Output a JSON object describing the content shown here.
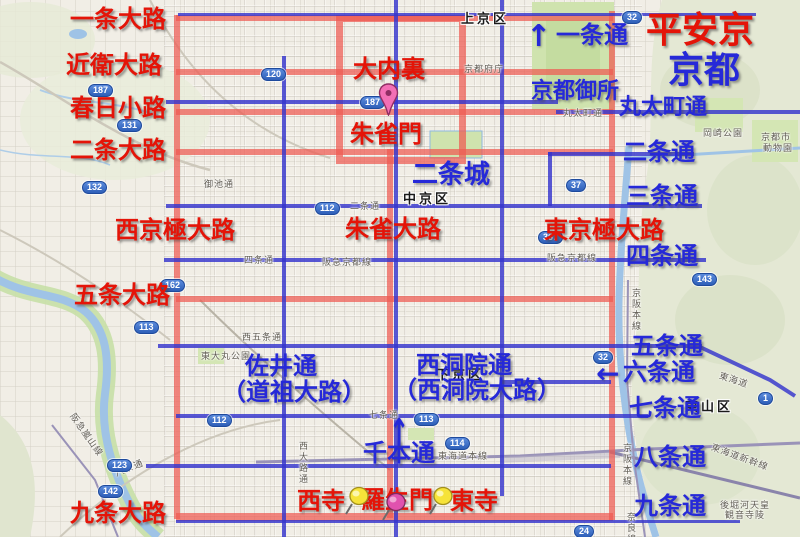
{
  "app": {
    "type": "map-screenshot",
    "description": "Heian-kyo ancient grid overlaid on modern Kyoto map"
  },
  "titles": {
    "ancient": {
      "text": "平安京"
    },
    "modern": {
      "text": "京都"
    }
  },
  "colors": {
    "ancient_label": "#e41408",
    "modern_label": "#2629d8",
    "ancient_line": "rgba(238,90,82,0.72)",
    "modern_line": "rgba(52,52,205,0.82)"
  },
  "districts": [
    {
      "text": "上京区",
      "x": 461,
      "y": 8
    },
    {
      "text": "中京区",
      "x": 403,
      "y": 188
    },
    {
      "text": "下京区",
      "x": 436,
      "y": 364
    },
    {
      "text": "東山区",
      "x": 685,
      "y": 396
    }
  ],
  "ancient_labels": [
    {
      "text": "一条大路",
      "x": 70,
      "y": 8
    },
    {
      "text": "近衛大路",
      "x": 66,
      "y": 54
    },
    {
      "text": "春日小路",
      "x": 70,
      "y": 97
    },
    {
      "text": "二条大路",
      "x": 70,
      "y": 139
    },
    {
      "text": "西京極大路",
      "x": 115,
      "y": 219
    },
    {
      "text": "五条大路",
      "x": 74,
      "y": 284
    },
    {
      "text": "九条大路",
      "x": 70,
      "y": 502
    },
    {
      "text": "大内裏",
      "x": 353,
      "y": 58
    },
    {
      "text": "朱雀門",
      "x": 350,
      "y": 123
    },
    {
      "text": "朱雀大路",
      "x": 345,
      "y": 218
    },
    {
      "text": "東京極大路",
      "x": 544,
      "y": 219
    },
    {
      "text": "西寺",
      "x": 297,
      "y": 490
    },
    {
      "text": "羅生門",
      "x": 361,
      "y": 489
    },
    {
      "text": "東寺",
      "x": 450,
      "y": 490
    }
  ],
  "modern_labels": [
    {
      "text": "一条通",
      "x": 556,
      "y": 24
    },
    {
      "text": "京都御所",
      "x": 531,
      "y": 79,
      "size": 22
    },
    {
      "text": "丸太町通",
      "x": 619,
      "y": 95,
      "size": 22
    },
    {
      "text": "二条通",
      "x": 623,
      "y": 141
    },
    {
      "text": "三条通",
      "x": 626,
      "y": 185
    },
    {
      "text": "四条通",
      "x": 626,
      "y": 245
    },
    {
      "text": "五条通",
      "x": 631,
      "y": 335
    },
    {
      "text": "六条通",
      "x": 623,
      "y": 361
    },
    {
      "text": "七条通",
      "x": 629,
      "y": 397
    },
    {
      "text": "八条通",
      "x": 634,
      "y": 446
    },
    {
      "text": "九条通",
      "x": 634,
      "y": 495
    },
    {
      "text": "二条城",
      "x": 412,
      "y": 161,
      "size": 26
    },
    {
      "text": "千本通",
      "x": 363,
      "y": 442
    },
    {
      "text": "佐井通",
      "x": 245,
      "y": 355
    },
    {
      "text": "（道祖大路）",
      "x": 222,
      "y": 381
    },
    {
      "text": "西洞院通",
      "x": 416,
      "y": 354
    },
    {
      "text": "（西洞院大路）",
      "x": 393,
      "y": 379
    }
  ],
  "arrows": [
    {
      "glyph": "↑",
      "x": 526,
      "y": 22,
      "size": 30
    },
    {
      "glyph": "↑",
      "x": 389,
      "y": 414,
      "size": 24,
      "stretch": 1.6
    },
    {
      "glyph": "←",
      "x": 596,
      "y": 360,
      "size": 28
    }
  ],
  "shields": [
    {
      "n": "187",
      "x": 88,
      "y": 84
    },
    {
      "n": "131",
      "x": 117,
      "y": 119
    },
    {
      "n": "132",
      "x": 82,
      "y": 181
    },
    {
      "n": "162",
      "x": 160,
      "y": 279
    },
    {
      "n": "113",
      "x": 134,
      "y": 321
    },
    {
      "n": "120",
      "x": 261,
      "y": 68
    },
    {
      "n": "187",
      "x": 360,
      "y": 96
    },
    {
      "n": "112",
      "x": 315,
      "y": 202
    },
    {
      "n": "112",
      "x": 207,
      "y": 414
    },
    {
      "n": "113",
      "x": 414,
      "y": 413
    },
    {
      "n": "114",
      "x": 445,
      "y": 437
    },
    {
      "n": "37",
      "x": 566,
      "y": 179
    },
    {
      "n": "367",
      "x": 538,
      "y": 231
    },
    {
      "n": "32",
      "x": 622,
      "y": 11
    },
    {
      "n": "32",
      "x": 593,
      "y": 351
    },
    {
      "n": "1",
      "x": 758,
      "y": 392
    },
    {
      "n": "143",
      "x": 692,
      "y": 273
    },
    {
      "n": "123",
      "x": 107,
      "y": 459
    },
    {
      "n": "142",
      "x": 98,
      "y": 485
    },
    {
      "n": "24",
      "x": 574,
      "y": 525
    }
  ],
  "pins": [
    {
      "type": "balloon",
      "name": "daidairi-pin",
      "x": 378,
      "y": 83
    },
    {
      "type": "pushpin-yellow",
      "name": "saiji-pin",
      "x": 343,
      "y": 484
    },
    {
      "type": "pushpin-magenta",
      "name": "rajomon-pin",
      "x": 380,
      "y": 490
    },
    {
      "type": "pushpin-yellow",
      "name": "toji-pin",
      "x": 427,
      "y": 484
    }
  ],
  "map_texts": [
    {
      "text": "丸太町通",
      "x": 563,
      "y": 106
    },
    {
      "text": "京都府庁",
      "x": 464,
      "y": 62
    },
    {
      "text": "御池通",
      "x": 204,
      "y": 177
    },
    {
      "text": "二条通",
      "x": 350,
      "y": 199
    },
    {
      "text": "四条通",
      "x": 244,
      "y": 253
    },
    {
      "text": "阪急京都線",
      "x": 322,
      "y": 255
    },
    {
      "text": "阪急京都線",
      "x": 547,
      "y": 251
    },
    {
      "text": "西五条通",
      "x": 242,
      "y": 330
    },
    {
      "text": "東大丸公園",
      "x": 201,
      "y": 349
    },
    {
      "text": "七条通",
      "x": 369,
      "y": 408
    },
    {
      "text": "八条通",
      "x": 114,
      "y": 461,
      "rot": -22
    },
    {
      "text": "西大路通",
      "x": 297,
      "y": 441,
      "vert": true
    },
    {
      "text": "東海道本線",
      "x": 438,
      "y": 449
    },
    {
      "text": "東海道",
      "x": 719,
      "y": 373,
      "rot": 18
    },
    {
      "text": "東海道新幹線",
      "x": 710,
      "y": 450,
      "rot": 20
    },
    {
      "text": "後堀河天皇",
      "x": 720,
      "y": 498
    },
    {
      "text": "観音寺陵",
      "x": 725,
      "y": 508
    },
    {
      "text": "京阪本線",
      "x": 621,
      "y": 443,
      "vert": true
    },
    {
      "text": "京阪本線",
      "x": 630,
      "y": 288,
      "vert": true
    },
    {
      "text": "岡崎公園",
      "x": 703,
      "y": 126
    },
    {
      "text": "京都市",
      "x": 761,
      "y": 130
    },
    {
      "text": "動物園",
      "x": 763,
      "y": 141
    },
    {
      "text": "阪急嵐山線",
      "x": 62,
      "y": 428,
      "rot": 55
    },
    {
      "text": "奈良線",
      "x": 625,
      "y": 512,
      "vert": true
    }
  ],
  "ancient_roads": {
    "horizontals": [
      {
        "id": "ichijo-oji",
        "x": 176,
        "y": 15,
        "w": 437
      },
      {
        "id": "konoe-oji",
        "x": 176,
        "y": 69,
        "w": 437
      },
      {
        "id": "kasuga-koji",
        "x": 176,
        "y": 109,
        "w": 437
      },
      {
        "id": "nijo-oji",
        "x": 176,
        "y": 149,
        "w": 437
      },
      {
        "id": "gojo-oji",
        "x": 176,
        "y": 296,
        "w": 437
      },
      {
        "id": "kujo-oji",
        "x": 176,
        "y": 513,
        "w": 437,
        "t": 8
      }
    ],
    "verticals": [
      {
        "id": "nishikyogoku-oji",
        "x": 174,
        "y": 15,
        "h": 504
      },
      {
        "id": "higashikyogoku-oji",
        "x": 609,
        "y": 11,
        "h": 509
      },
      {
        "id": "suzaku-oji",
        "x": 387,
        "y": 149,
        "h": 369
      }
    ],
    "palace": {
      "id": "daidairi",
      "x": 336,
      "y": 15,
      "w": 116,
      "h": 135
    }
  },
  "modern_roads": {
    "horizontals": [
      {
        "id": "ichijo-dori",
        "x": 178,
        "y": 13,
        "w": 578,
        "t": 3
      },
      {
        "id": "marutamachi-dori-w",
        "x": 166,
        "y": 100,
        "w": 392
      },
      {
        "id": "marutamachi-dori-e",
        "x": 556,
        "y": 110,
        "w": 244
      },
      {
        "id": "nijo-dori",
        "x": 548,
        "y": 152,
        "w": 146
      },
      {
        "id": "oike-sanjo-dori",
        "x": 166,
        "y": 204,
        "w": 536
      },
      {
        "id": "shijo-dori",
        "x": 164,
        "y": 258,
        "w": 542
      },
      {
        "id": "gojo-dori",
        "x": 158,
        "y": 344,
        "w": 544
      },
      {
        "id": "rokujo-dori",
        "x": 502,
        "y": 380,
        "w": 109
      },
      {
        "id": "shichijo-dori",
        "x": 176,
        "y": 414,
        "w": 472
      },
      {
        "id": "hachijo-dori",
        "x": 146,
        "y": 464,
        "w": 465
      },
      {
        "id": "kujo-dori",
        "x": 176,
        "y": 520,
        "w": 564,
        "t": 3
      }
    ],
    "verticals": [
      {
        "id": "nishioji-dori",
        "x": 282,
        "y": 56,
        "h": 481
      },
      {
        "id": "senbon-dori",
        "x": 394,
        "y": 0,
        "h": 537
      },
      {
        "id": "nishinotoin-dori",
        "x": 500,
        "y": 0,
        "h": 496
      },
      {
        "id": "nijo-dori-link",
        "x": 548,
        "y": 152,
        "h": 54
      }
    ]
  }
}
